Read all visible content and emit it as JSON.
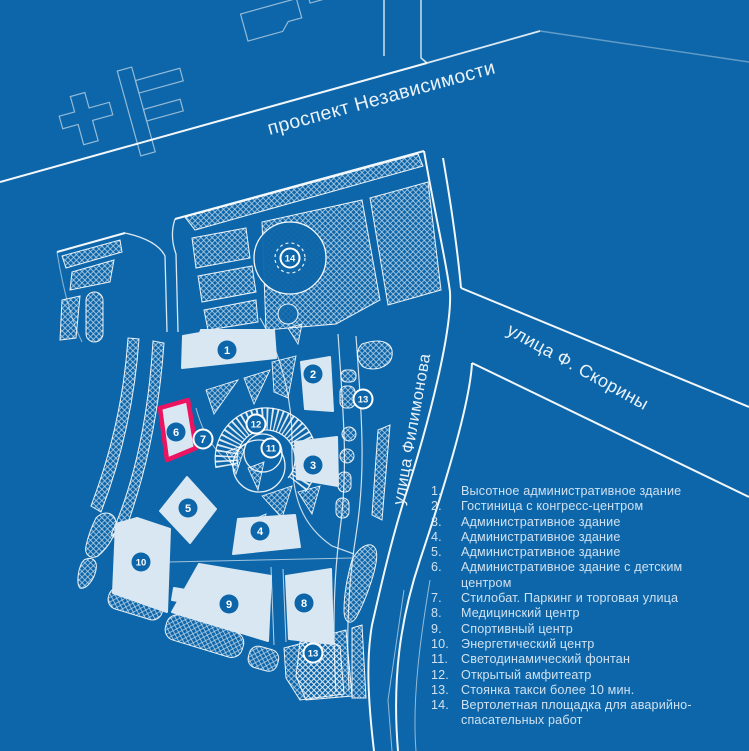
{
  "map": {
    "background": "#0d66a9",
    "line_color": "#ffffff",
    "building_fill": "#d9e7f2",
    "highlight_color": "#ec1460",
    "streets": [
      {
        "id": "prospekt-nezavisimosti",
        "label": "проспект Независимости"
      },
      {
        "id": "ulitsa-filimonova",
        "label": "улица Филимонова"
      },
      {
        "id": "ulitsa-skoriny",
        "label": "улица Ф. Скорины"
      }
    ],
    "markers": [
      {
        "num": "1",
        "x": 227,
        "y": 350,
        "ring": false,
        "highlighted": false
      },
      {
        "num": "2",
        "x": 313,
        "y": 374,
        "ring": false,
        "highlighted": false
      },
      {
        "num": "3",
        "x": 313,
        "y": 465,
        "ring": false,
        "highlighted": false
      },
      {
        "num": "4",
        "x": 260,
        "y": 531,
        "ring": false,
        "highlighted": false
      },
      {
        "num": "5",
        "x": 188,
        "y": 508,
        "ring": false,
        "highlighted": false
      },
      {
        "num": "6",
        "x": 176,
        "y": 432,
        "ring": false,
        "highlighted": true
      },
      {
        "num": "7",
        "x": 203,
        "y": 439,
        "ring": true,
        "highlighted": false
      },
      {
        "num": "8",
        "x": 304,
        "y": 603,
        "ring": false,
        "highlighted": false
      },
      {
        "num": "9",
        "x": 229,
        "y": 604,
        "ring": false,
        "highlighted": false
      },
      {
        "num": "10",
        "x": 141,
        "y": 562,
        "ring": false,
        "highlighted": false
      },
      {
        "num": "11",
        "x": 271,
        "y": 448,
        "ring": true,
        "highlighted": false
      },
      {
        "num": "12",
        "x": 256,
        "y": 424,
        "ring": true,
        "highlighted": false
      },
      {
        "num": "13",
        "x": 363,
        "y": 399,
        "ring": true,
        "highlighted": false
      },
      {
        "num": "13",
        "x": 313,
        "y": 653,
        "ring": true,
        "highlighted": false
      },
      {
        "num": "14",
        "x": 290,
        "y": 258,
        "ring": true,
        "highlighted": false
      }
    ]
  },
  "legend": {
    "items": [
      {
        "num": "1.",
        "text": "Высотное административное здание"
      },
      {
        "num": "2.",
        "text": "Гостиница с конгресс-центром"
      },
      {
        "num": "3.",
        "text": "Административное здание"
      },
      {
        "num": "4.",
        "text": "Административное здание"
      },
      {
        "num": "5.",
        "text": "Административное здание"
      },
      {
        "num": "6.",
        "text": "Административное здание с детским центром"
      },
      {
        "num": "7.",
        "text": "Стилобат. Паркинг и торговая улица"
      },
      {
        "num": "8.",
        "text": "Медицинский центр"
      },
      {
        "num": "9.",
        "text": "Спортивный центр"
      },
      {
        "num": "10.",
        "text": "Энергетический центр"
      },
      {
        "num": "11.",
        "text": "Светодинамический фонтан"
      },
      {
        "num": "12.",
        "text": "Открытый амфитеатр"
      },
      {
        "num": "13.",
        "text": "Стоянка такси более 10 мин."
      },
      {
        "num": "14.",
        "text": "Вертолетная площадка для аварийно-спасательных работ"
      }
    ]
  }
}
